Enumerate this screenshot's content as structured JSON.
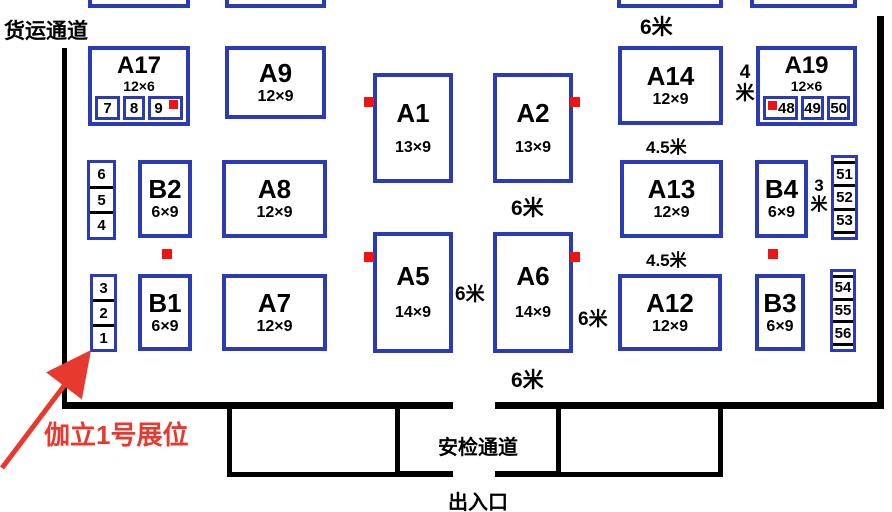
{
  "colors": {
    "booth_border_blue": "#2b3ab5",
    "marker_red": "#ee1414",
    "annotation_red": "#e8392f",
    "wall_black": "#000000"
  },
  "labels": {
    "freight_channel": "货运通道",
    "security_channel": "安检通道",
    "entrance_exit": "出入口",
    "annotation": "伽立1号展位"
  },
  "distance_labels": {
    "top_aisle": "6米",
    "below_a2": "6米",
    "a14_a19_gap": "4米",
    "above_a13": "4.5米",
    "below_a13": "4.5米",
    "b4_gap": "3米",
    "a5_a6_gap": "6米",
    "a6_a12_gap": "6米",
    "below_a6": "6米"
  },
  "booths": {
    "a17": {
      "id": "A17",
      "size": "12×6"
    },
    "a9": {
      "id": "A9",
      "size": "12×9"
    },
    "a1": {
      "id": "A1",
      "size": "13×9"
    },
    "a2": {
      "id": "A2",
      "size": "13×9"
    },
    "a14": {
      "id": "A14",
      "size": "12×9"
    },
    "a19": {
      "id": "A19",
      "size": "12×6"
    },
    "b2": {
      "id": "B2",
      "size": "6×9"
    },
    "a8": {
      "id": "A8",
      "size": "12×9"
    },
    "a13": {
      "id": "A13",
      "size": "12×9"
    },
    "b4": {
      "id": "B4",
      "size": "6×9"
    },
    "b1": {
      "id": "B1",
      "size": "6×9"
    },
    "a7": {
      "id": "A7",
      "size": "12×9"
    },
    "a5": {
      "id": "A5",
      "size": "14×9"
    },
    "a6": {
      "id": "A6",
      "size": "14×9"
    },
    "a12": {
      "id": "A12",
      "size": "12×9"
    },
    "b3": {
      "id": "B3",
      "size": "6×9"
    }
  },
  "small_booths": {
    "a17_strip": [
      "7",
      "8",
      "9"
    ],
    "a19_strip": [
      "48",
      "49",
      "50"
    ],
    "left_stack_upper": [
      "6",
      "5",
      "4"
    ],
    "left_stack_lower": [
      "3",
      "2",
      "1"
    ],
    "right_stack_upper": [
      "51",
      "52",
      "53"
    ],
    "right_stack_lower": [
      "54",
      "55",
      "56"
    ]
  }
}
